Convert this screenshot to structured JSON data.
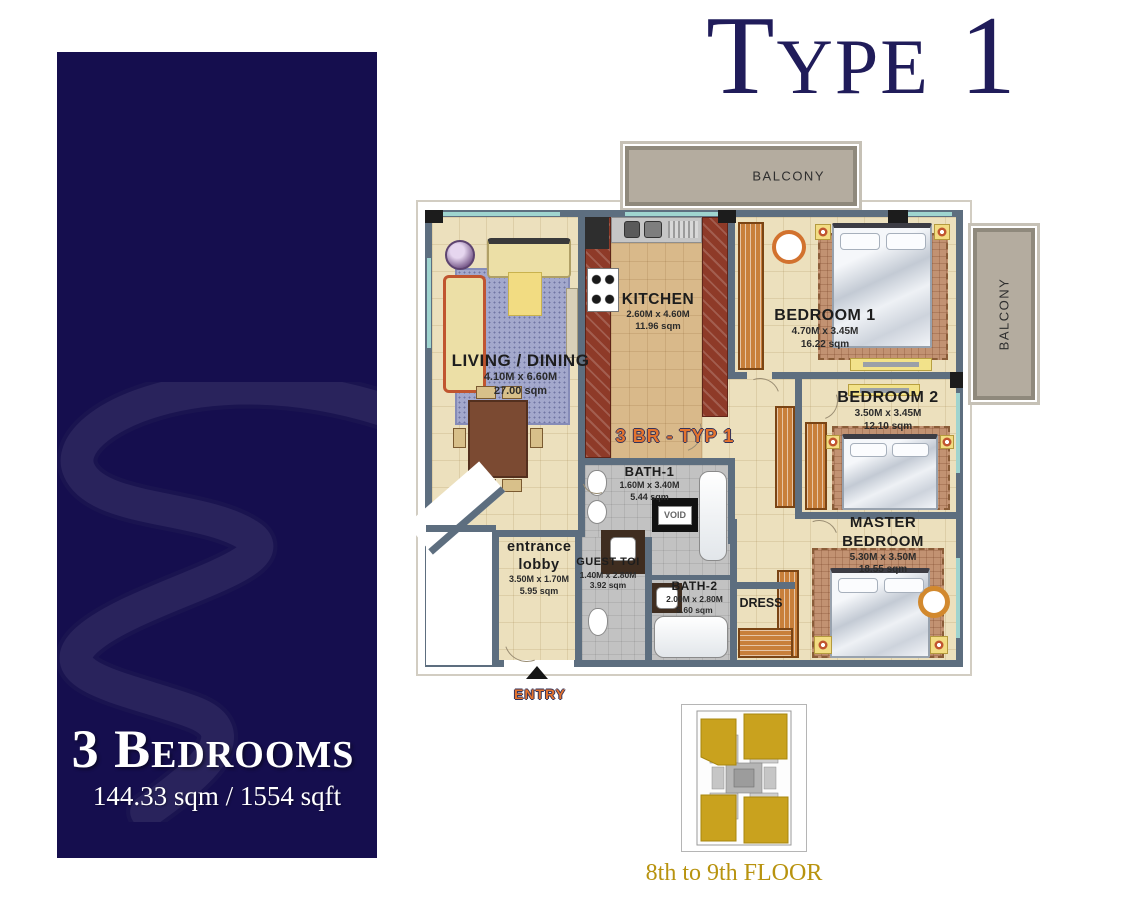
{
  "header": {
    "title": "Type 1"
  },
  "sidebar": {
    "heading": "3 Bedrooms",
    "area": "144.33 sqm / 1554 sqft",
    "watermark_icon": "s-swoosh"
  },
  "floorplan": {
    "unit_label": "3 BR - TYP 1",
    "entry_label": "ENTRY",
    "void_label": "VOID",
    "balcony_top": "BALCONY",
    "balcony_right": "BALCONY",
    "living": {
      "name": "LIVING / DINING",
      "dims": "4.10M x 6.60M",
      "area": "27.00 sqm"
    },
    "kitchen": {
      "name": "KITCHEN",
      "dims": "2.60M x 4.60M",
      "area": "11.96 sqm"
    },
    "bedroom1": {
      "name": "BEDROOM 1",
      "dims": "4.70M x 3.45M",
      "area": "16.22 sqm"
    },
    "bedroom2": {
      "name": "BEDROOM 2",
      "dims": "3.50M x 3.45M",
      "area": "12.10 sqm"
    },
    "master": {
      "name": "MASTER BEDROOM",
      "dims": "5.30M x 3.50M",
      "area": "18.55 sqm"
    },
    "bath1": {
      "name": "BATH-1",
      "dims": "1.60M x 3.40M",
      "area": "5.44 sqm"
    },
    "bath2": {
      "name": "BATH-2",
      "dims": "2.00M x 2.80M",
      "area": "5.60 sqm"
    },
    "guest": {
      "name": "GUEST TOI",
      "dims": "1.40M x 2.80M",
      "area": "3.92 sqm"
    },
    "lobby": {
      "name": "entrance lobby",
      "dims": "3.50M x 1.70M",
      "area": "5.95 sqm"
    },
    "dress": {
      "name": "DRESS"
    }
  },
  "keyplan": {
    "caption": "8th to 9th FLOOR"
  },
  "colors": {
    "sidebar_bg": "#150e4e",
    "title_navy": "#201c5a",
    "label_orange": "#e4732e",
    "wall_slate": "#5d6e7f",
    "floor_cream": "#ece0bd",
    "keyplan_gold": "#c9a21e",
    "caption_gold": "#b8930f"
  }
}
